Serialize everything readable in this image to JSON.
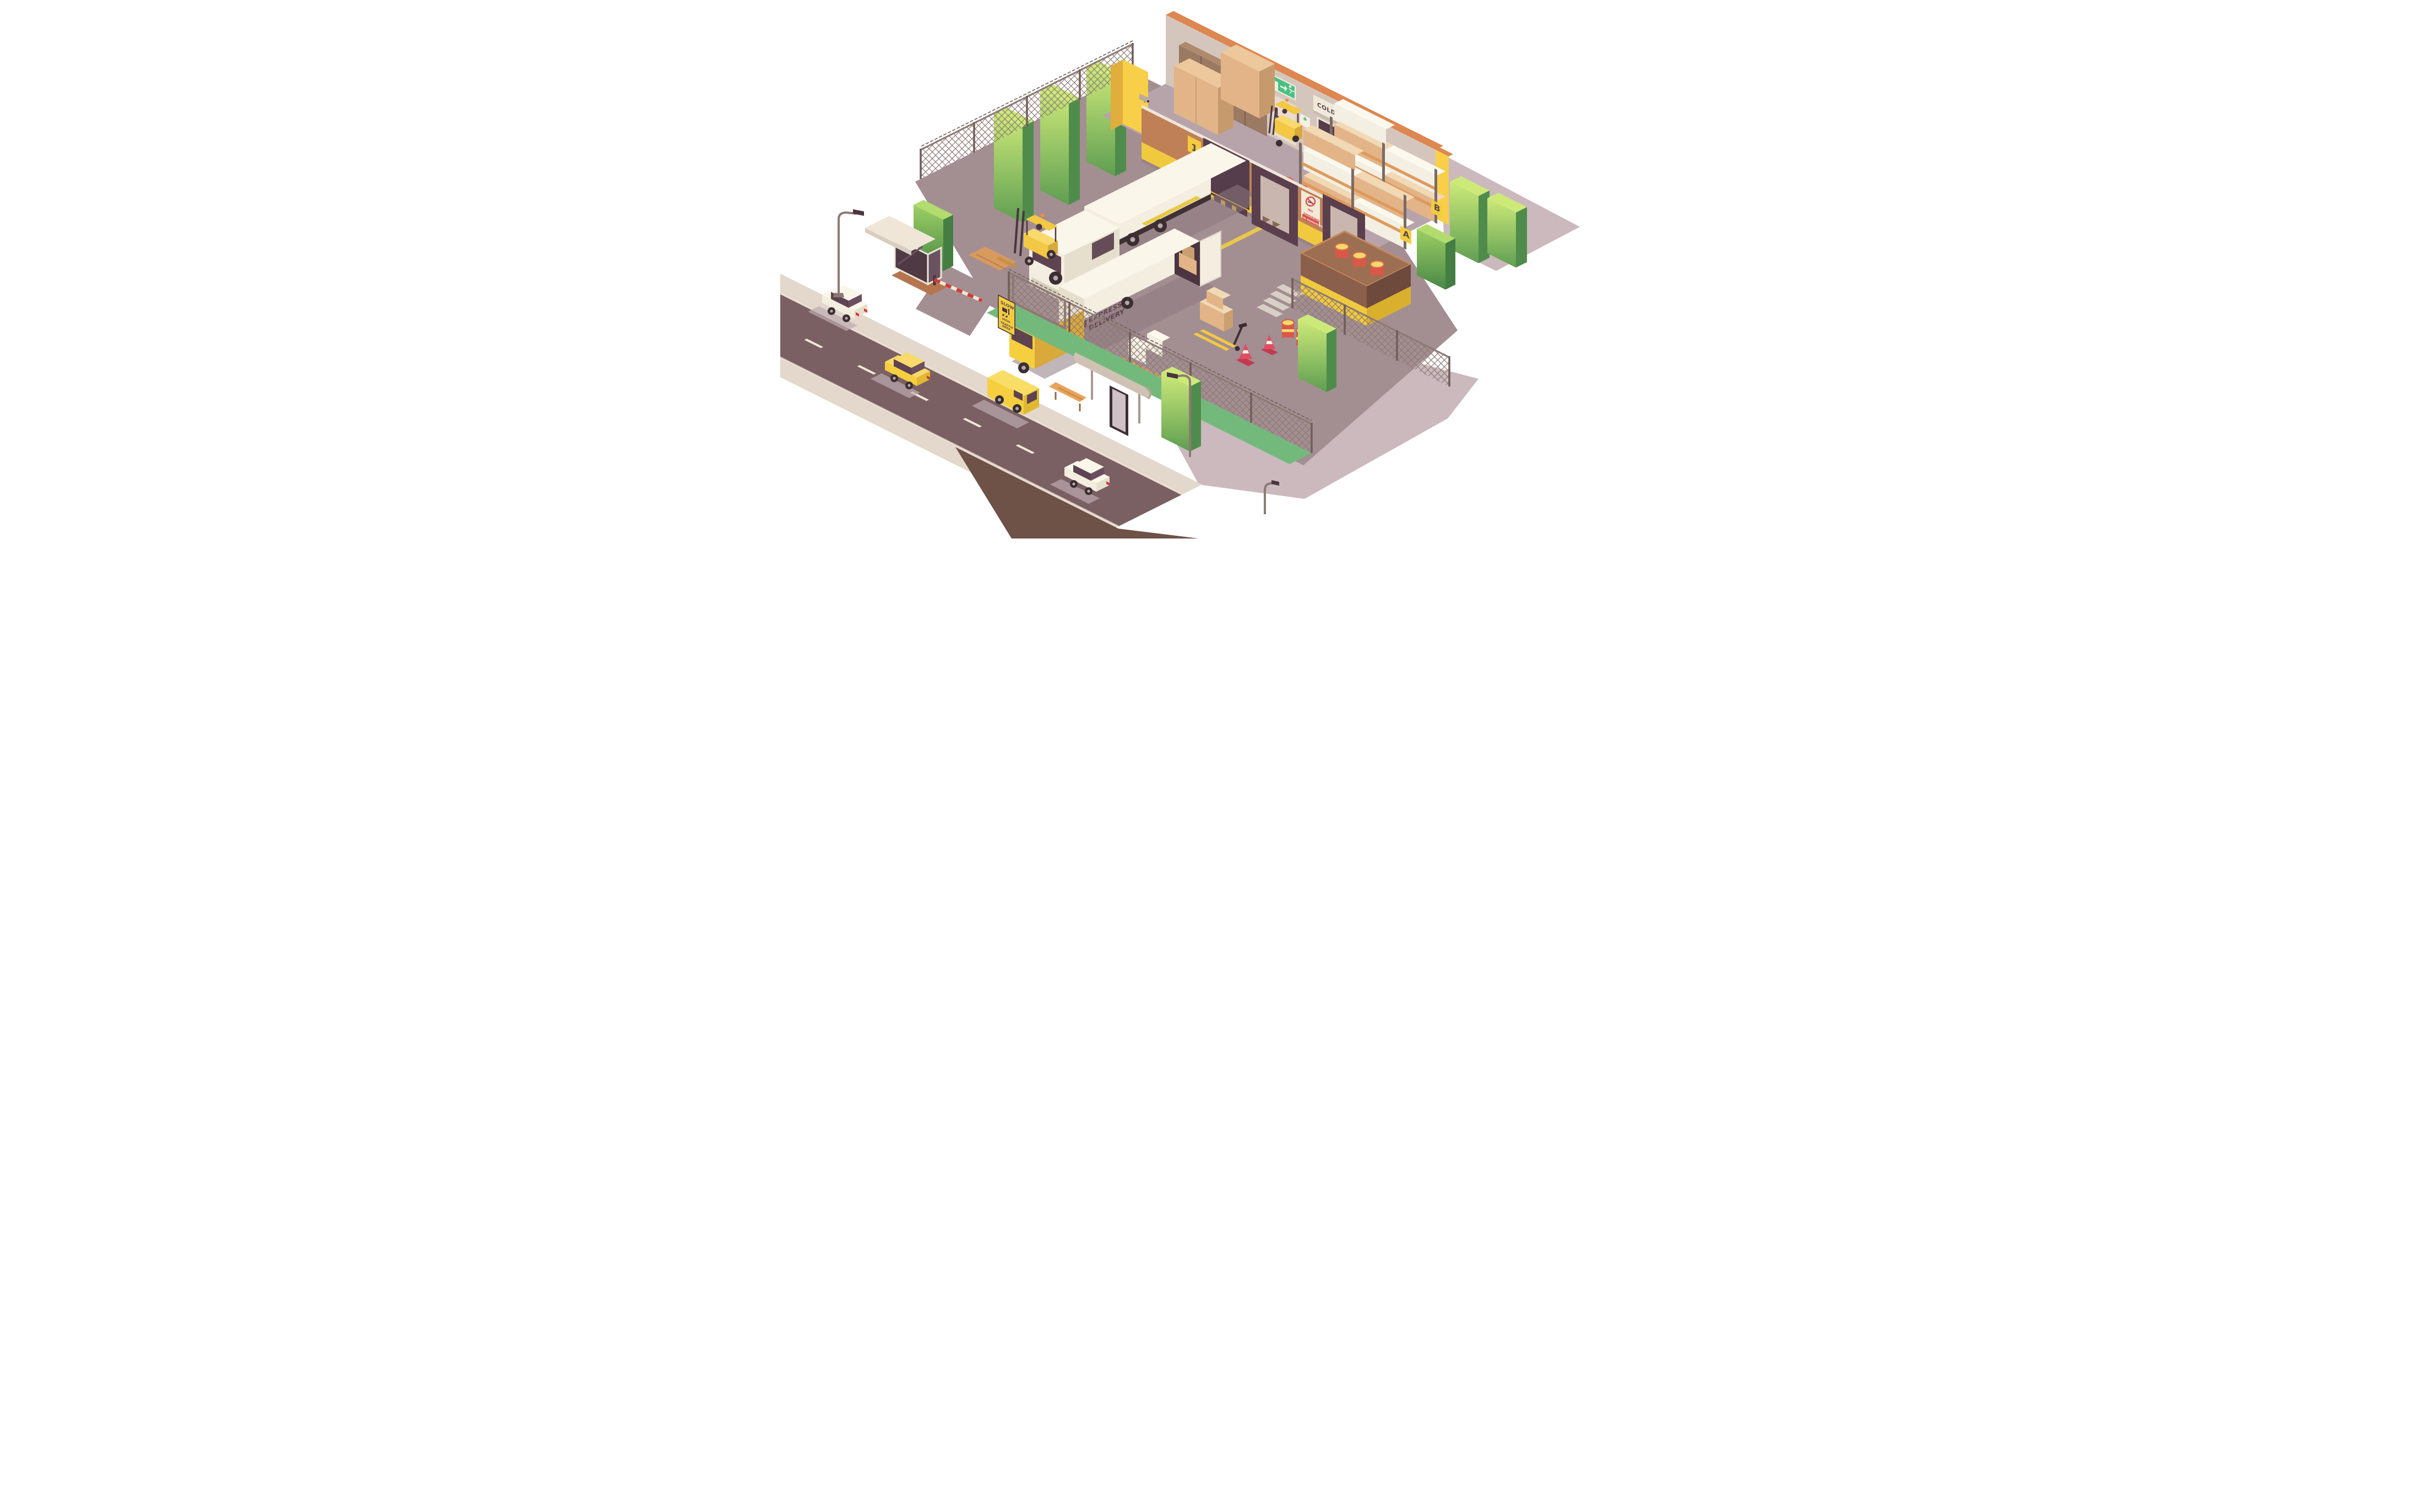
{
  "scene": {
    "type": "isometric-cutaway-illustration",
    "subject": "Low-poly warehouse with loading docks, storage racks, yard, guard booth and street"
  },
  "signs": {
    "cold_storage": "COLD STORAGE",
    "dock_number": "1",
    "rack_a": "A",
    "rack_b": "B",
    "no_smoking": {
      "l1": "NO",
      "l2": "SMOKING",
      "l3": "IN WAREHOUSE"
    },
    "fire_extinguisher": {
      "l1": "FIRE",
      "l2": "EXTINGUISHER"
    },
    "slow": {
      "l1": "SLOW",
      "l2": "HIGH",
      "l3": "TRAFFIC",
      "l4": "AREA"
    },
    "van_livery": {
      "l1": "EXPRESS",
      "l2": "DELIVERY"
    }
  },
  "colors": {
    "background": "#ffffff",
    "shadow": "#cbb9be",
    "road": "#7a6063",
    "road_marking": "#f0e8d8",
    "sidewalk": "#e3d8cb",
    "dirt": "#6e5147",
    "grass": "#74b97c",
    "tree_light": "#cdea79",
    "tree_dark": "#4f8c4b",
    "fence": "#8d7a74",
    "yard": "#a38e92",
    "yard_line": "#e8c84a",
    "floor": "#b7a4ab",
    "wall_back": "#d5c6bd",
    "wall_top_trim": "#dd8751",
    "wall_front": "#c08057",
    "wall_front_band": "#f0c93f",
    "wall_cut": "#f8cf48",
    "wall_trim": "#efe6d8",
    "dock_dark": "#563d4b",
    "rack_post": "#7c6a66",
    "rack_beam": "#df9a5c",
    "box_cardboard": "#e2b488",
    "box_white": "#f3efe3",
    "pallet": "#d99a5e",
    "truck_white": "#f3eee0",
    "cab_window": "#5e4351",
    "van_yellow": "#f5cf3f",
    "forklift_yellow": "#f2c844",
    "barrel_red": "#d95848",
    "barrel_lid": "#f3d96a",
    "sign_red": "#d94f4c",
    "sign_green": "#47c183",
    "sign_yellow": "#f2cc3e",
    "cone": "#de4f63",
    "bench": "#e8a45c",
    "booth_dark": "#4f3a44"
  },
  "objects": [
    "guard booth with barrier gate",
    "chain-link fence with barbed wire",
    "trees and hedges",
    "street with two cars and a yellow van",
    "bus stop with bench and ad panel",
    "street lamps",
    "semi-trailer truck docked at door 1",
    "yellow forklifts",
    "express delivery box van with open rear",
    "hand pallet truck",
    "pallets with cardboard and white boxes",
    "traffic cones",
    "oil drums",
    "pallet racking bays A and B",
    "storage lockers",
    "fire extinguishers and fire sign",
    "cold storage door",
    "emergency exit door and exit sign",
    "first aid kit",
    "barrel storage platform with stairs"
  ]
}
